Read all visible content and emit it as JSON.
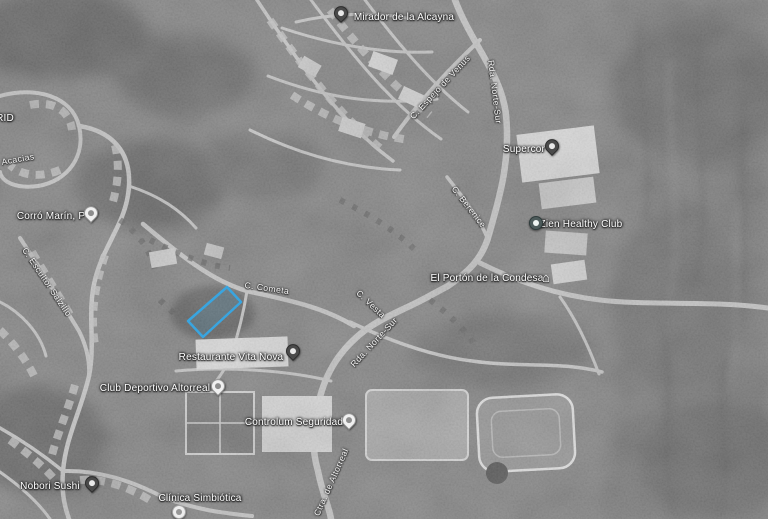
{
  "map": {
    "description": "Grayscale satellite map of the Altorreal / La Alcayna area with a highlighted land parcel outlined in blue",
    "view": "satellite-grayscale",
    "highlight_color": "#3aa7e0",
    "label_text_color": "#ffffff",
    "parcel": {
      "points": "227,287 241,302 203,337 188,321"
    },
    "places": [
      {
        "label": "Mirador de la Alcayna",
        "tx": 404,
        "ty": 16,
        "pin": {
          "x": 341,
          "y": 18,
          "style": "dark",
          "icon": "photo-pin-icon"
        }
      },
      {
        "label": "RID",
        "tx": 5,
        "ty": 117,
        "pin": null
      },
      {
        "label": "Corró Marín, P",
        "tx": 51,
        "ty": 215,
        "pin": {
          "x": 91,
          "y": 218,
          "style": "white",
          "icon": "place-pin-icon"
        }
      },
      {
        "label": "Supercor",
        "tx": 524,
        "ty": 148,
        "pin": {
          "x": 552,
          "y": 151,
          "style": "dark",
          "icon": "shopping-pin-icon"
        }
      },
      {
        "label": "Zien Healthy Club",
        "tx": 581,
        "ty": 223,
        "pin": {
          "x": 536,
          "y": 223,
          "style": "circle-dark",
          "icon": "leisure-pin-icon"
        }
      },
      {
        "label": "El Portón de la Condesa",
        "tx": 487,
        "ty": 277,
        "pin": {
          "x": 548,
          "y": 275,
          "style": "house",
          "icon": "monument-icon"
        }
      },
      {
        "label": "Restaurante Vita Nova",
        "tx": 231,
        "ty": 356,
        "pin": {
          "x": 293,
          "y": 356,
          "style": "dark",
          "icon": "restaurant-pin-icon"
        }
      },
      {
        "label": "Club Deportivo Altorreal",
        "tx": 155,
        "ty": 387,
        "pin": {
          "x": 218,
          "y": 391,
          "style": "white",
          "icon": "place-pin-icon"
        }
      },
      {
        "label": "Controlum Seguridad",
        "tx": 294,
        "ty": 421,
        "pin": {
          "x": 349,
          "y": 425,
          "style": "white",
          "icon": "place-pin-icon"
        }
      },
      {
        "label": "Nobori Sushi",
        "tx": 50,
        "ty": 485,
        "pin": {
          "x": 92,
          "y": 488,
          "style": "dark",
          "icon": "restaurant-pin-icon"
        }
      },
      {
        "label": "Clínica Simbiótica",
        "tx": 200,
        "ty": 497,
        "pin": {
          "x": 179,
          "y": 512,
          "style": "circle-light",
          "icon": "health-pin-icon"
        }
      }
    ],
    "streets": [
      {
        "label": "C. Espejo de Venus",
        "x": 440,
        "y": 87,
        "rotate": -47
      },
      {
        "label": "Rda. Norte-Sur",
        "x": 495,
        "y": 92,
        "rotate": 83
      },
      {
        "label": "C. Berenice",
        "x": 469,
        "y": 207,
        "rotate": 52
      },
      {
        "label": "Acacias",
        "x": 18,
        "y": 159,
        "rotate": -10
      },
      {
        "label": "C. Escultor Salzillo",
        "x": 47,
        "y": 282,
        "rotate": 56
      },
      {
        "label": "C. Cometa",
        "x": 267,
        "y": 288,
        "rotate": 8
      },
      {
        "label": "C. Vesta",
        "x": 371,
        "y": 304,
        "rotate": 43
      },
      {
        "label": "Rda. Norte-Sur",
        "x": 374,
        "y": 342,
        "rotate": -47
      },
      {
        "label": "Ctra. de Altorreal",
        "x": 331,
        "y": 482,
        "rotate": -66
      }
    ]
  }
}
